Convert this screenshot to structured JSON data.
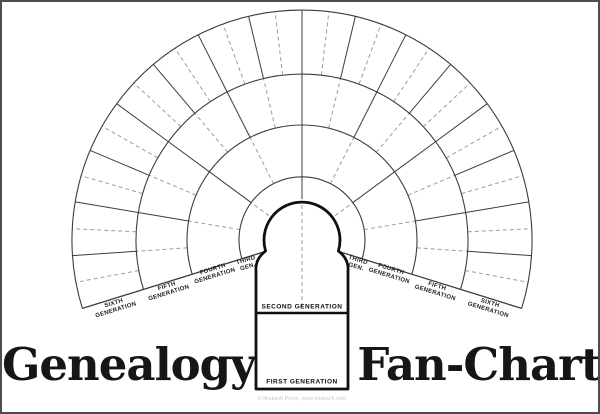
{
  "titles": {
    "left": "Genealogy",
    "right": "Fan-Chart"
  },
  "center": {
    "second_label": "SECOND GENERATION",
    "first_label": "FIRST GENERATION"
  },
  "footer": {
    "credit": "© Misbach Press, www.misbach.com"
  },
  "generation_labels": {
    "left": {
      "sixth": {
        "line1": "SIXTH",
        "line2": "GENERATION"
      },
      "fifth": {
        "line1": "FIFTH",
        "line2": "GENERATION"
      },
      "fourth": {
        "line1": "FOURTH",
        "line2": "GENERATION"
      },
      "third": {
        "line1": "THIRD",
        "line2": "GEN."
      }
    },
    "right": {
      "third": {
        "line1": "THIRD",
        "line2": "GEN."
      },
      "fourth": {
        "line1": "FOURTH",
        "line2": "GENERATION"
      },
      "fifth": {
        "line1": "FIFTH",
        "line2": "GENERATION"
      },
      "sixth": {
        "line1": "SIXTH",
        "line2": "GENERATION"
      }
    }
  },
  "fan": {
    "cx": 300,
    "cy": 238,
    "angle_start_deg": -17.3,
    "angle_end_deg": 197.3,
    "rings": [
      {
        "name": "third-generation",
        "inner_radius": 41,
        "outer_radius": 63,
        "slots": 4
      },
      {
        "name": "fourth-generation",
        "inner_radius": 63,
        "outer_radius": 115,
        "slots": 8
      },
      {
        "name": "fifth-generation",
        "inner_radius": 115,
        "outer_radius": 166,
        "slots": 16
      },
      {
        "name": "sixth-generation",
        "inner_radius": 166,
        "outer_radius": 230,
        "slots": 32
      }
    ],
    "edge_inner_radius": 41,
    "line_color": "#3c3c3c",
    "dash_color": "#9c9c9c",
    "arch_color": "#0f0f0f"
  }
}
